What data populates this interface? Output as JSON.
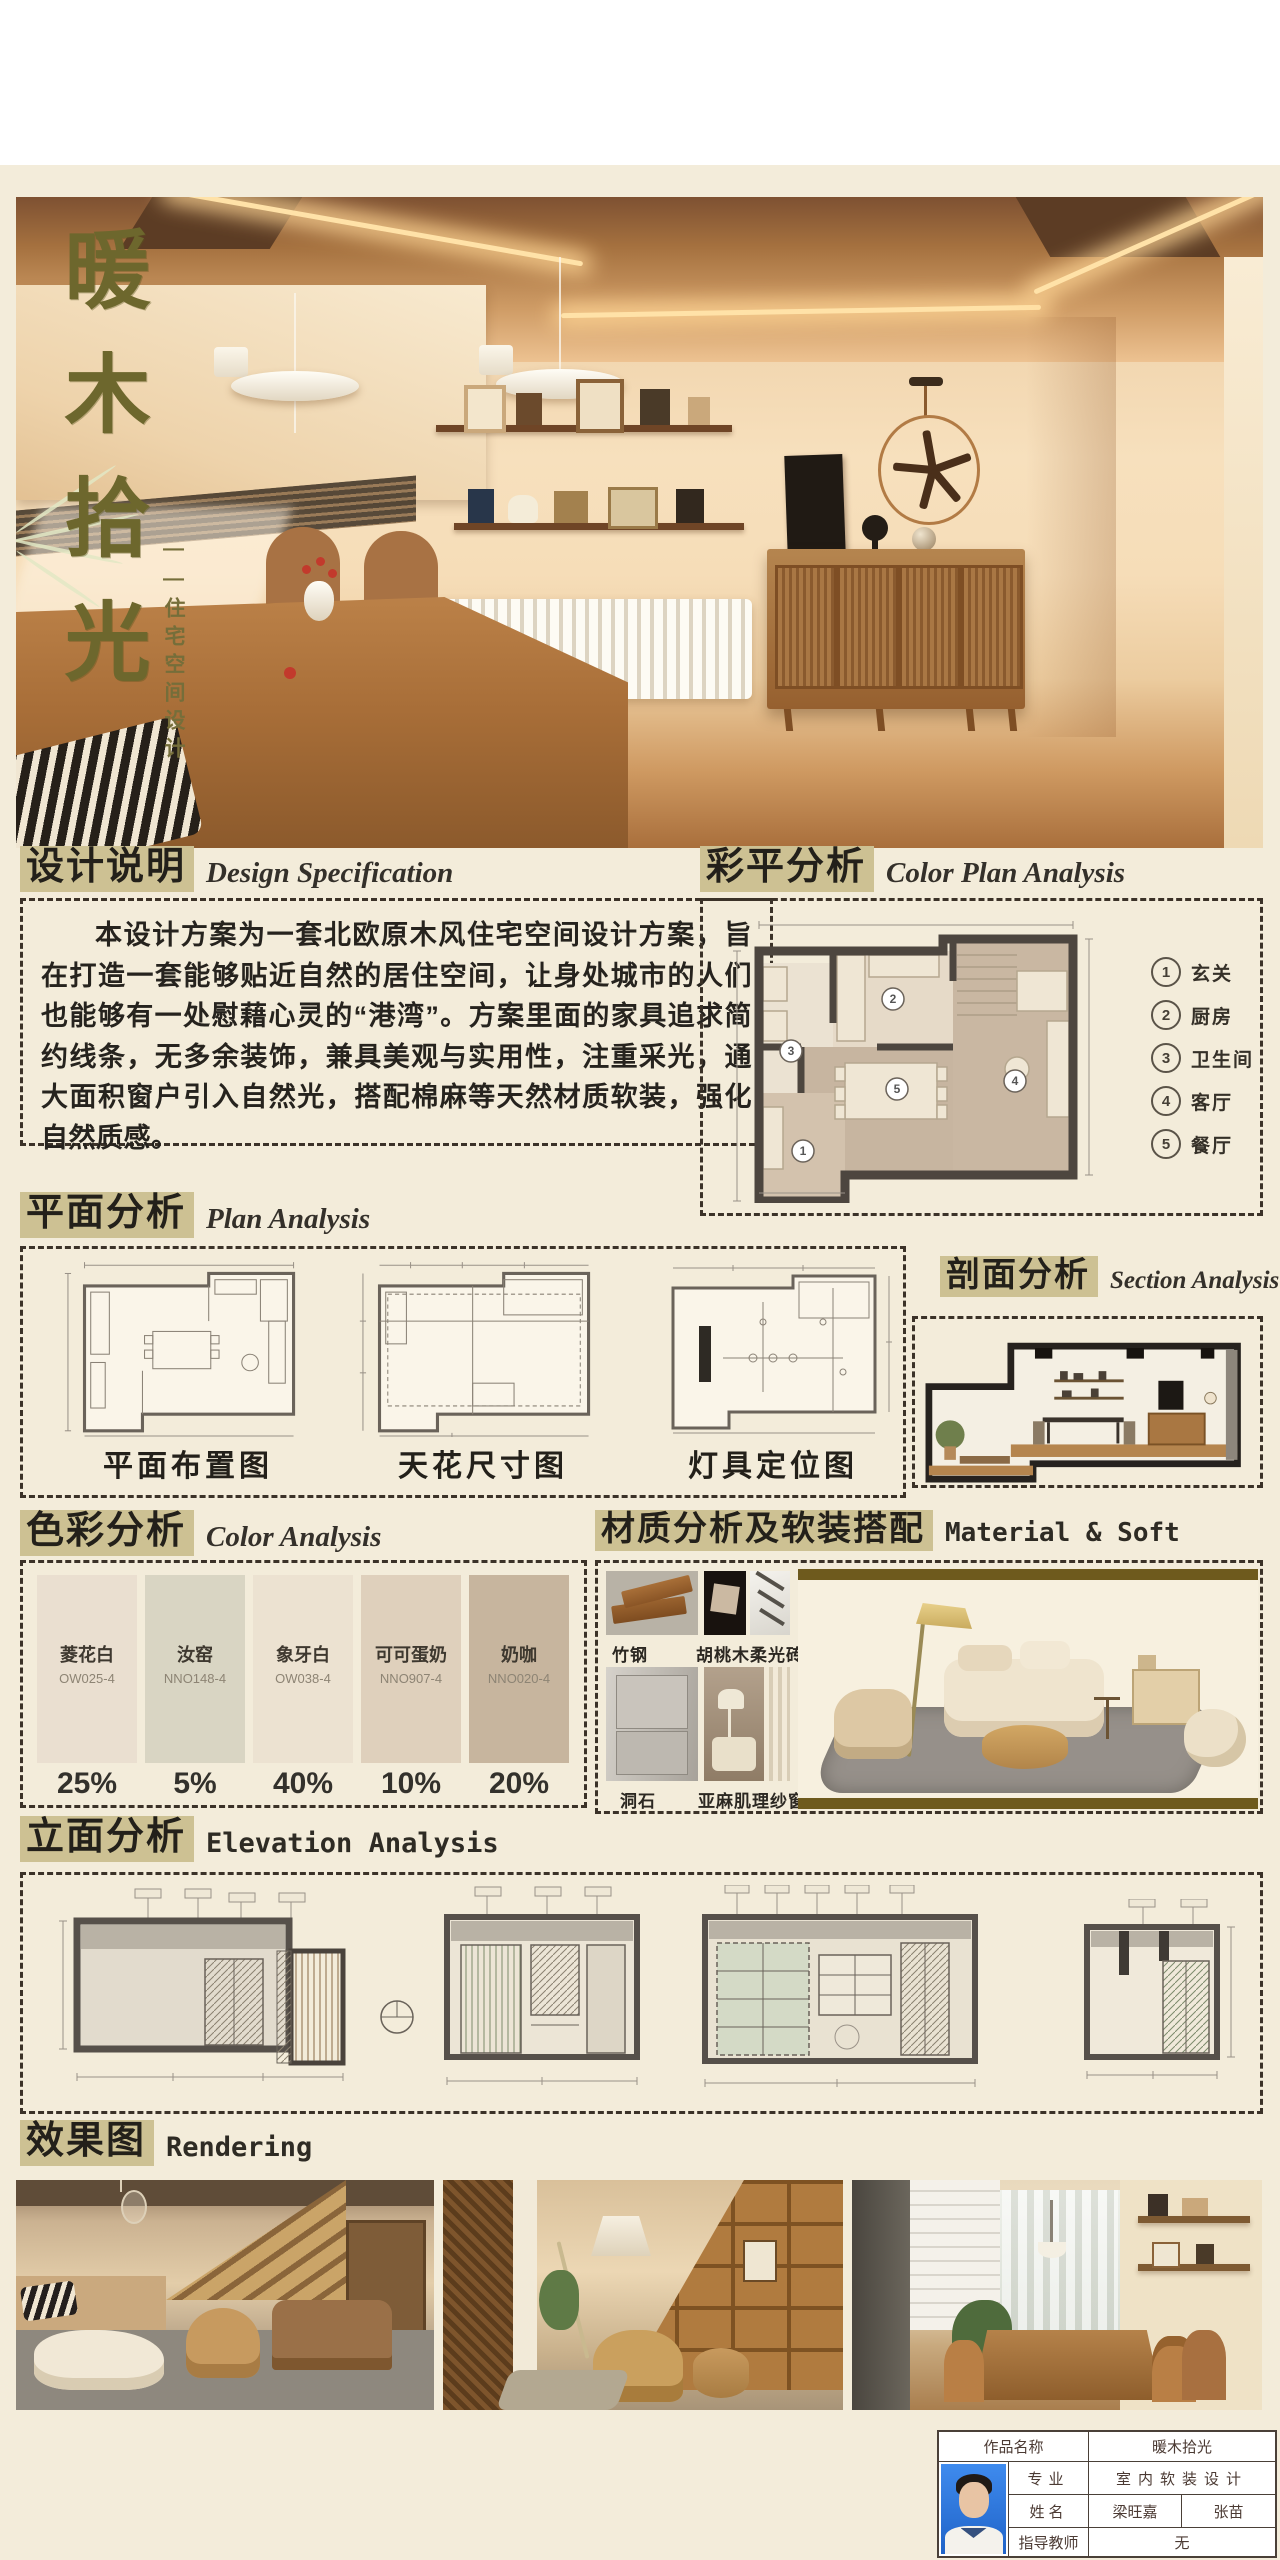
{
  "hero": {
    "title": "暖木拾光",
    "subtitle": "——住宅空间设计"
  },
  "design_spec": {
    "zh": "设计说明",
    "en": "Design Specification",
    "body": "本设计方案为一套北欧原木风住宅空间设计方案，旨在打造一套能够贴近自然的居住空间，让身处城市的人们也能够有一处慰藉心灵的“港湾”。方案里面的家具追求简约线条，无多余装饰，兼具美观与实用性，注重采光，通大面积窗户引入自然光，搭配棉麻等天然材质软装，强化自然质感。"
  },
  "color_plan": {
    "zh": "彩平分析",
    "en": "Color Plan Analysis",
    "legend": [
      {
        "n": "1",
        "label": "玄关"
      },
      {
        "n": "2",
        "label": "厨房"
      },
      {
        "n": "3",
        "label": "卫生间"
      },
      {
        "n": "4",
        "label": "客厅"
      },
      {
        "n": "5",
        "label": "餐厅"
      }
    ]
  },
  "plan": {
    "zh": "平面分析",
    "en": "Plan Analysis",
    "figures": [
      "平面布置图",
      "天花尺寸图",
      "灯具定位图"
    ]
  },
  "section_analysis": {
    "zh": "剖面分析",
    "en": "Section Analysis"
  },
  "color": {
    "zh": "色彩分析",
    "en": "Color Analysis",
    "swatches": [
      {
        "name": "菱花白",
        "code": "OW025-4",
        "pct": "25%",
        "hex": "#eadfd0"
      },
      {
        "name": "汝窑",
        "code": "NNO148-4",
        "pct": "5%",
        "hex": "#d9d5c3"
      },
      {
        "name": "象牙白",
        "code": "OW038-4",
        "pct": "40%",
        "hex": "#ece2d1"
      },
      {
        "name": "可可蛋奶",
        "code": "NNO907-4",
        "pct": "10%",
        "hex": "#dfd0bc"
      },
      {
        "name": "奶咖",
        "code": "NNO020-4",
        "pct": "20%",
        "hex": "#c7b59e"
      }
    ]
  },
  "material": {
    "zh": "材质分析及软装搭配",
    "en": "Material & Soft",
    "labels": [
      "竹钢",
      "胡桃木",
      "柔光砖",
      "洞石",
      "亚麻肌理纱窗"
    ]
  },
  "elevation": {
    "zh": "立面分析",
    "en": "Elevation Analysis"
  },
  "rendering": {
    "zh": "效果图",
    "en": "Rendering"
  },
  "info": {
    "work_label": "作品名称",
    "work": "暖木拾光",
    "major_label": "专业",
    "major": "室内软装设计",
    "name_label": "姓名",
    "name1": "梁旺嘉",
    "name2": "张苗",
    "advisor_label": "指导教师",
    "advisor": "无"
  }
}
